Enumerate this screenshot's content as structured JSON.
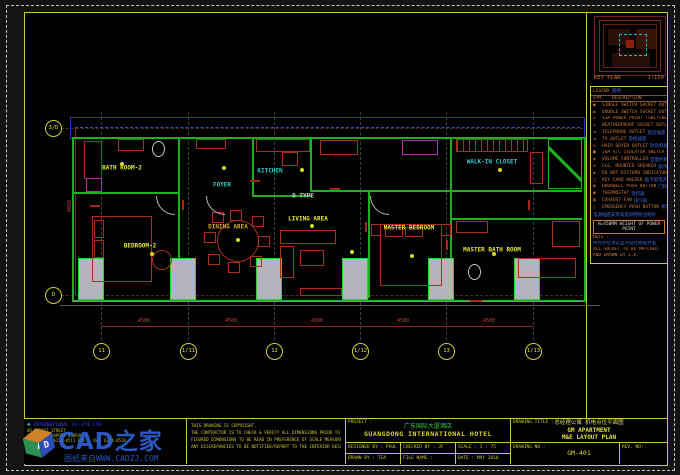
{
  "key_plan": {
    "label": "KEY PLAN",
    "scale": "1:150"
  },
  "legend": {
    "title": "LEGEND",
    "title_cn": "图例",
    "header_sym": "SYM.",
    "header_desc": "DESCRIPTION",
    "rows": [
      {
        "sym": "●",
        "en": "SINGLE SWITCH SOCKET OUTLET",
        "cn": "单联开关插座"
      },
      {
        "sym": "◐",
        "en": "DOUBLE SWITCH SOCKET OUTLET",
        "cn": "双联开关插座"
      },
      {
        "sym": "⊥",
        "en": "13A POWER POINT (SWITCHED)",
        "cn": "带开关电源插座"
      },
      {
        "sym": "⊥",
        "en": "WEATHERPROOF SOCKET OUTLET",
        "cn": "防水电源插座"
      },
      {
        "sym": "◄",
        "en": "TELEPHONE OUTLET",
        "cn": "电话插座"
      },
      {
        "sym": "◄",
        "en": "TV OUTLET",
        "cn": "电视插座"
      },
      {
        "sym": "⊙",
        "en": "HAIR DRYER OUTLET",
        "cn": "吹风机插座"
      },
      {
        "sym": "■",
        "en": "20A A/C ISOLATOR SWITCH",
        "cn": "空调隔离开关"
      },
      {
        "sym": "◍",
        "en": "VOLUME CONTROLLER",
        "cn": "音量控制器"
      },
      {
        "sym": "⊕",
        "en": "CLG. MOUNTED SPEAKER",
        "cn": "吸顶扬声器"
      },
      {
        "sym": "▪",
        "en": "DO NOT DISTURB INDICATOR",
        "cn": "请勿打扰显示"
      },
      {
        "sym": "□",
        "en": "KEY CARD HOLDER",
        "cn": "插卡取电开关"
      },
      {
        "sym": "◉",
        "en": "DOORBELL PUSH BUTTON",
        "cn": "门铃按钮"
      },
      {
        "sym": "▣",
        "en": "THERMOSTAT",
        "cn": "温控器"
      },
      {
        "sym": "▨",
        "en": "EXHAUST FAN",
        "cn": "排气扇"
      },
      {
        "sym": "△",
        "en": "EMERGENCY PUSH BUTTON",
        "cn": "紧急按钮"
      }
    ],
    "height_note_cn": "电源插座安装高度除特别注明外",
    "height_note_en": "H=450MM  HEIGHT OF POWER POINT",
    "note_title": "NOTE :",
    "note_lines": [
      {
        "text": "所有点位须以室内设计图纸为准",
        "color": "#4868e0"
      },
      {
        "text": "ALL SOCKET TO BE MATCHED",
        "color": "#c87838"
      },
      {
        "text": "AND DRAWN BY I.D.",
        "color": "#c87838"
      }
    ]
  },
  "plan": {
    "rooms": [
      {
        "label": "BATH ROOM-2",
        "x": 122,
        "y": 168,
        "color": "#e8e838"
      },
      {
        "label": "BEDROOM-2",
        "x": 140,
        "y": 246,
        "color": "#e8e838"
      },
      {
        "label": "FOYER",
        "x": 222,
        "y": 185,
        "color": "#38c8c8"
      },
      {
        "label": "KITCHEN",
        "x": 270,
        "y": 171,
        "color": "#38c8c8"
      },
      {
        "label": "DINING AREA",
        "x": 228,
        "y": 227,
        "color": "#d8a830"
      },
      {
        "label": "B TYPE",
        "x": 303,
        "y": 196,
        "color": "#c8c8c8"
      },
      {
        "label": "LIVING AREA",
        "x": 308,
        "y": 219,
        "color": "#e8e838"
      },
      {
        "label": "MASTER BEDROOM",
        "x": 409,
        "y": 228,
        "color": "#e8e838"
      },
      {
        "label": "WALK-IN CLOSET",
        "x": 492,
        "y": 162,
        "color": "#38c8c8"
      },
      {
        "label": "MASTER BATH ROOM",
        "x": 492,
        "y": 250,
        "color": "#e8e838"
      }
    ],
    "grid_cols": [
      {
        "label": "11",
        "x": 101
      },
      {
        "label": "1/11",
        "x": 188
      },
      {
        "label": "12",
        "x": 274
      },
      {
        "label": "1/12",
        "x": 360
      },
      {
        "label": "13",
        "x": 446
      },
      {
        "label": "1/13",
        "x": 533
      }
    ],
    "grid_rows": [
      {
        "label": "3/D",
        "y": 128
      },
      {
        "label": "D",
        "y": 295
      }
    ],
    "dims_bottom": [
      {
        "text": "4500",
        "x": 144
      },
      {
        "text": "4500",
        "x": 231
      },
      {
        "text": "4500",
        "x": 317
      },
      {
        "text": "4500",
        "x": 403
      },
      {
        "text": "4500",
        "x": 489
      }
    ],
    "dim_left": "8050"
  },
  "title_block": {
    "copyright_lines": [
      "THIS DRAWING IS COPYRIGHT.",
      "THE CONTRACTOR IS TO CHECK & VERIFY ALL DIMENSIONS PRIOR TO PROCEEDING WORK.",
      "FIGURED DIMENSIONS TO BE READ IN PREFERENCE OF SCALE MEASUREMENT.",
      "ANY DISCREPANCIES TO BE NOTIFIED/REPORT TO THE INTERIOR DESIGNER."
    ],
    "company": {
      "name": "INTERNATIONAL (S) PTE LTD",
      "addr1": "6B MARKET STREET",
      "addr2": "#03-01 SINGAPORE 048940",
      "addr3": "TEL : (65) 6224-0511   FAX : (65) 6224-0510"
    },
    "watermark": {
      "brand": "CAD之家",
      "line": "图纸来自WWW.CADZJ.COM",
      "letter_a": "A",
      "letter_d": "D"
    },
    "project": {
      "label": "PROJECT    :",
      "cn": "广东国际大厦酒店",
      "en": "GUANGDONG INTERNATIONAL HOTEL"
    },
    "fields": {
      "designed": "DESIGNED BY : PAUL",
      "checked": "CHECKED BY : JF",
      "scale": "SCALE : 1 : 75",
      "drawn": "DRAWN BY : TEA",
      "file": "FILE NAME :",
      "date": "DATE : MAY 2010"
    },
    "drawing": {
      "title_label": "DRAWING TITLE :",
      "cn": "总经理公寓  机电点位平面图",
      "en1": "GM APARTMENT",
      "en2": "M&E LAYOUT PLAN",
      "no_label": "DRAWING NO :",
      "no": "GM-401",
      "rev_label": "REV. NO:"
    }
  }
}
